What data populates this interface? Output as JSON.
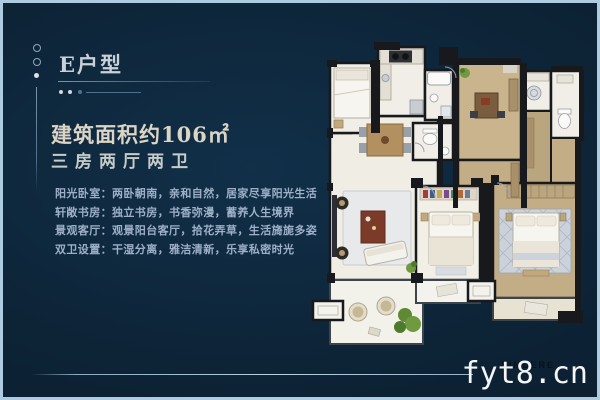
{
  "panel": {
    "title": "E户型",
    "area": "建筑面积约106㎡",
    "layout": "三房两厅两卫",
    "features": [
      "阳光卧室：两卧朝南，亲和自然，居家尽享阳光生活",
      "轩敞书房：独立书房，书香弥漫，蓄养人生境界",
      "景观客厅：观景阳台客厅，拾花弄草，生活旖旎多姿",
      "双卫设置：干湿分离，雅洁清新，乐享私密时光"
    ]
  },
  "watermark": {
    "text": "fyt8.cn",
    "ghost": "SINCERE"
  },
  "colors": {
    "background": "#0d2336",
    "frame": "#aecbdf",
    "title_text": "#c9d0d8",
    "area_text": "#dcd5c5",
    "feature_text": "#9db0c8",
    "watermark_text": "#f3f5f7",
    "plan_wall": "#17191d",
    "plan_floor_light": "#efede4",
    "plan_floor_tan": "#c3ad87"
  }
}
